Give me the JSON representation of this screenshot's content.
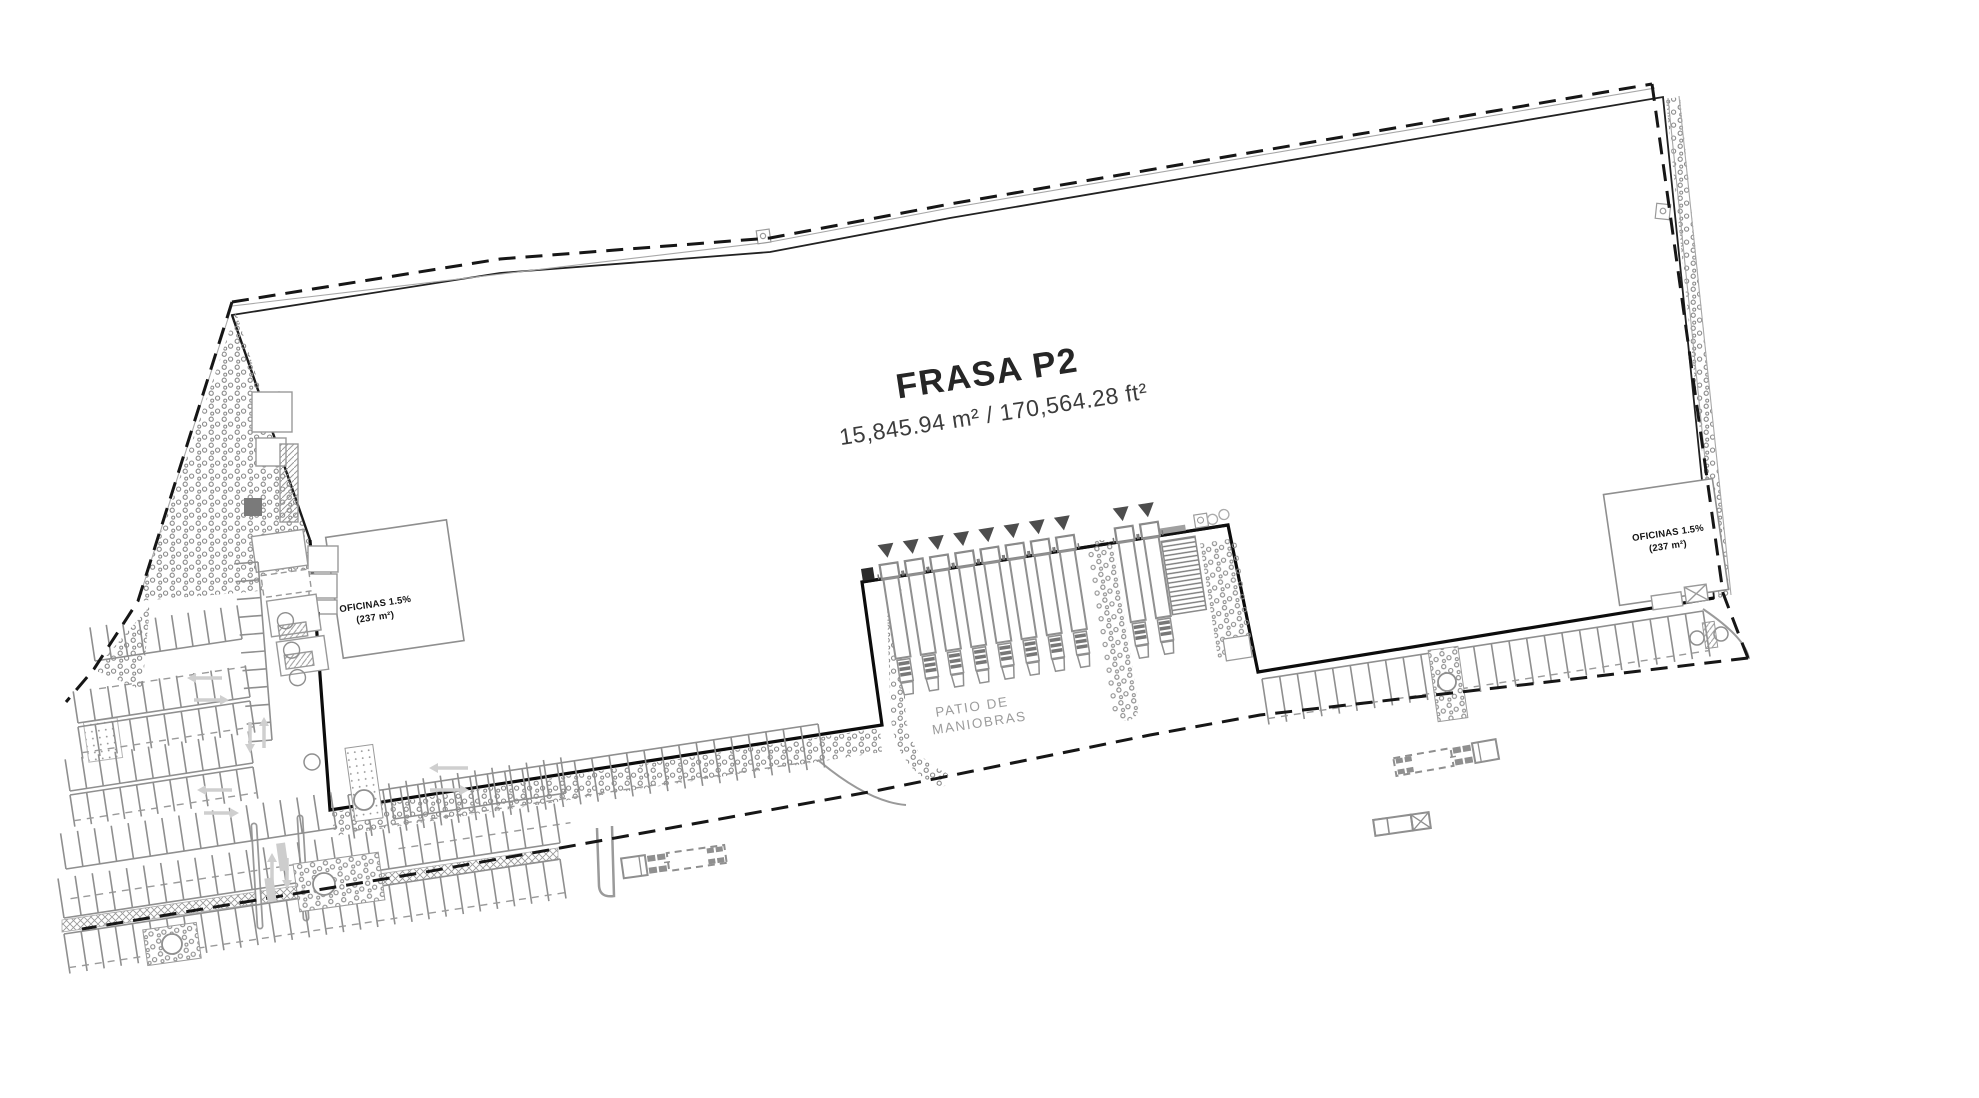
{
  "plan": {
    "building": {
      "title": "FRASA P2",
      "area": "15,845.94 m² / 170,564.28 ft²"
    },
    "yard": {
      "line1": "PATIO DE",
      "line2": "MANIOBRAS"
    },
    "offices": {
      "left": {
        "label": "OFICINAS 1.5%",
        "area": "(237 m²)"
      },
      "right": {
        "label": "OFICINAS 1.5%",
        "area": "(237 m²)"
      }
    },
    "docks": {
      "left_count": 8,
      "right_count": 2
    },
    "colors": {
      "paper": "#ffffff",
      "wall": "#111111",
      "line_gray": "#8f8f8f",
      "light_gray": "#cccccc",
      "muted_text": "#9c9c9c",
      "stipple": "#8a8a8a",
      "triangle": "#4d4d4d",
      "dash": "#161616"
    }
  }
}
